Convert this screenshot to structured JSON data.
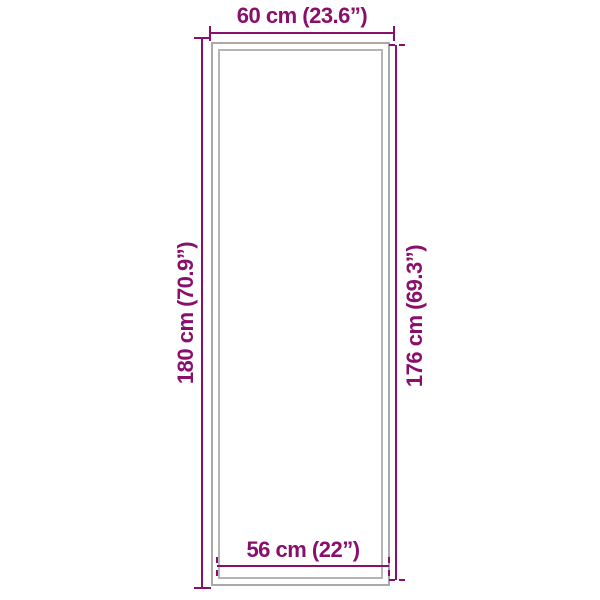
{
  "diagram": {
    "type": "product-dimension-diagram",
    "shape": "tall-rectangle-mat",
    "dimensions": {
      "top": {
        "label": "60 cm (23.6”)",
        "meaning": "outer width"
      },
      "left": {
        "label": "180 cm (70.9”)",
        "meaning": "outer height"
      },
      "right": {
        "label": "176 cm (69.3”)",
        "meaning": "inner height"
      },
      "bottom": {
        "label": "56 cm (22”)",
        "meaning": "inner width"
      }
    }
  },
  "colors": {
    "dimension_accent": "#8a0f6d",
    "mat_outer_border": "#a9a9a9",
    "mat_inner_border": "#b5b5b5",
    "background": "#ffffff"
  }
}
